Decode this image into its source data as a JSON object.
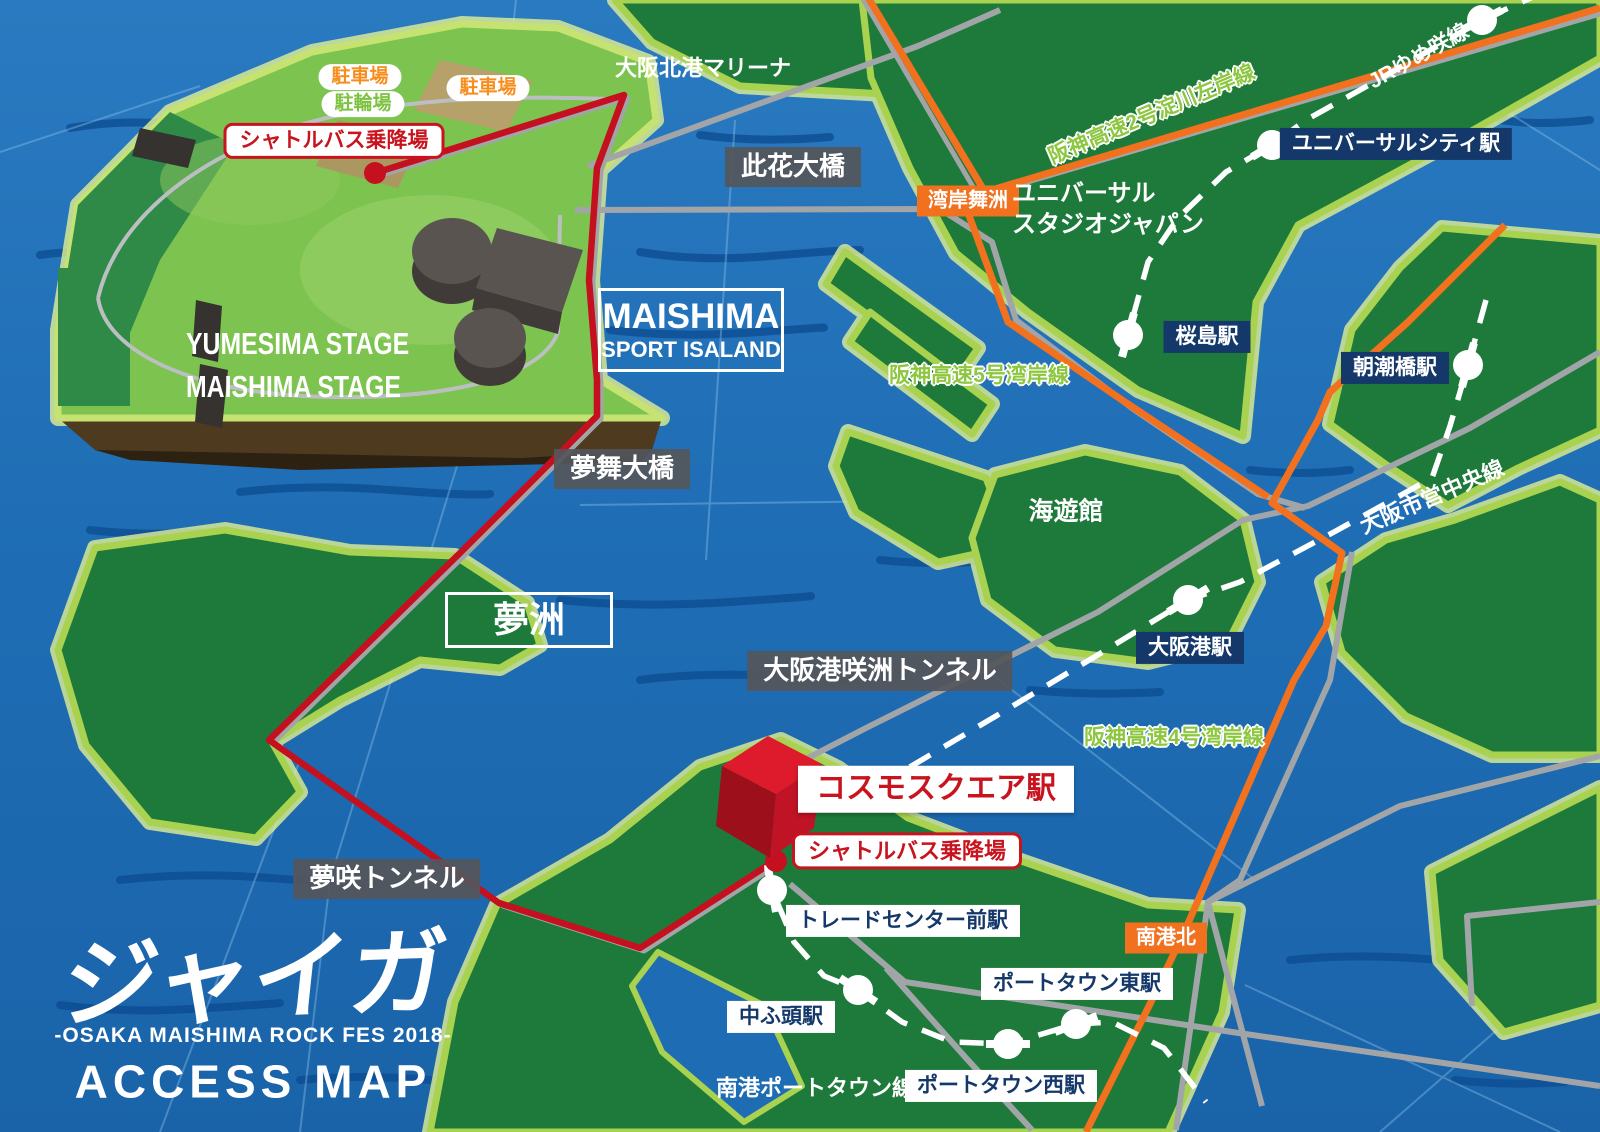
{
  "logo": {
    "name": "ジャイガ",
    "subtitle": "-OSAKA MAISHIMA ROCK FES 2018-",
    "heading": "ACCESS MAP"
  },
  "festival": {
    "parking1": "駐車場",
    "bicycle": "駐輪場",
    "parking2": "駐車場",
    "shuttle_north": "シャトルバス乗降場",
    "stage1": "YUMESIMA STAGE",
    "stage2": "MAISHIMA STAGE",
    "island_line1": "MAISHIMA",
    "island_line2": "SPORT ISALAND"
  },
  "places": {
    "marina": "大阪北港マリーナ",
    "konohana_bridge": "此花大橋",
    "usj_line1": "ユニバーサル",
    "usj_line2": "スタジオジャパン",
    "yumemai_bridge": "夢舞大橋",
    "yumeshima": "夢洲",
    "kaiyukan": "海遊館",
    "sakishima_tunnel": "大阪港咲洲トンネル",
    "yumesaki_tunnel": "夢咲トンネル",
    "shuttle_south": "シャトルバス乗降場"
  },
  "highways": {
    "hanshin2": "阪神高速2号淀川左岸線",
    "hanshin5": "阪神高速5号湾岸線",
    "hanshin4": "阪神高速4号湾岸線",
    "wangan_maishima_ic": "湾岸舞洲",
    "nankokita_ic": "南港北"
  },
  "railways": {
    "jr_yumesaki": "JRゆめ咲線",
    "chuo_line": "大阪市営中央線",
    "nanko_port_town": "南港ポートタウン線"
  },
  "stations": {
    "universal_city": "ユニバーサルシティ駅",
    "sakurajima": "桜島駅",
    "asashiobashi": "朝潮橋駅",
    "osakako": "大阪港駅",
    "cosmosquare": "コスモスクエア駅",
    "trade_center": "トレードセンター前駅",
    "nakafuto": "中ふ頭駅",
    "porttown_east": "ポートタウン東駅",
    "porttown_west": "ポートタウン西駅"
  },
  "colors": {
    "water": "#1e6db4",
    "water_dark_streak": "#0d4d92",
    "land": "#1d7a3b",
    "land_festival": "#7cc34f",
    "land_edge": "#c6e371",
    "road_gray": "#a2a5a8",
    "highway_orange": "#f2711f",
    "shuttle_route_red": "#c4101f",
    "station_navy": "#15386a",
    "label_gray_box": "#55565a",
    "label_red": "#c8141e",
    "highway_text_green": "#8dc63f"
  }
}
